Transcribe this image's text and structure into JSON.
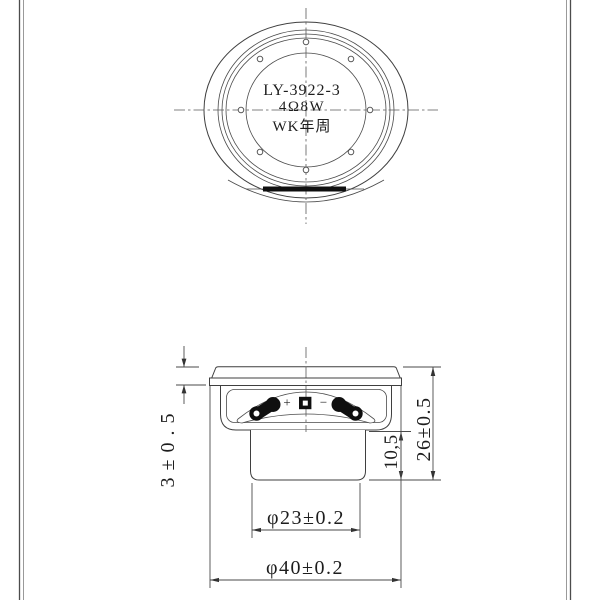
{
  "sheet": {
    "background": "#ffffff",
    "border_color": "#4c4c4c"
  },
  "colors": {
    "line": "#3f3f3f",
    "text": "#1d1d1d",
    "terminal_fill": "#0f0f0f"
  },
  "top_view": {
    "model": "LY-3922-3",
    "spec": "4Ω8W",
    "mark": "WK年周"
  },
  "side_view": {
    "polarity_plus": "+",
    "polarity_minus": "−"
  },
  "dimensions": {
    "flange_height": "3±0.5",
    "magnet_height": "10,5",
    "total_height": "26±0.5",
    "magnet_diameter": "φ23±0.2",
    "frame_diameter": "φ40±0.2"
  }
}
